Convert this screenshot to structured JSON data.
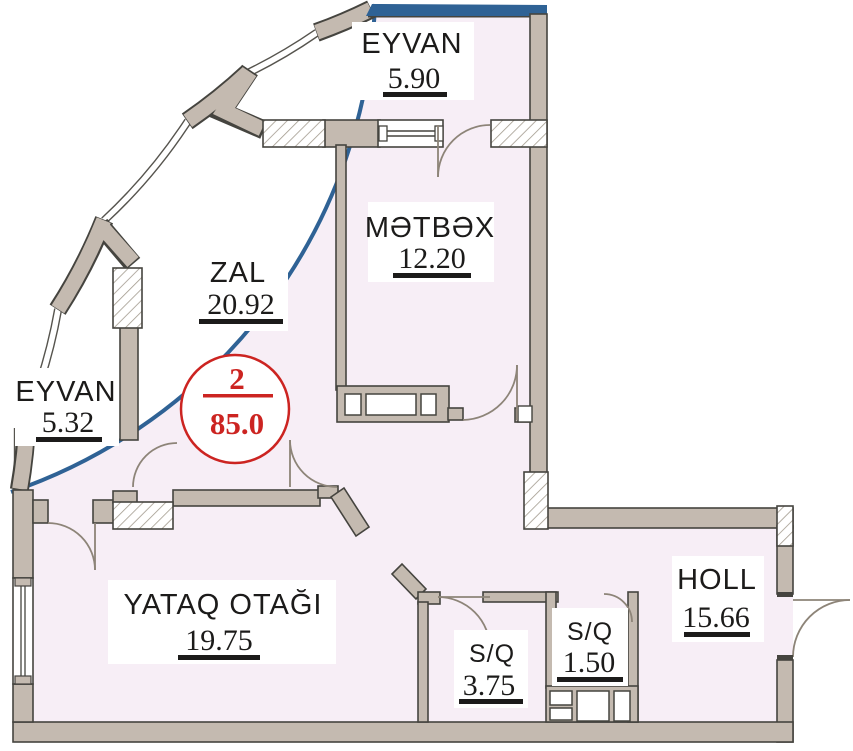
{
  "plan": {
    "title": "apartment-floor-plan",
    "badge": {
      "rooms_count": "2",
      "total_area": "85.0"
    },
    "rooms": [
      {
        "id": "eyvan-top",
        "name": "EYVAN",
        "area": "5.90"
      },
      {
        "id": "metbex",
        "name": "MƏTBƏX",
        "area": "12.20"
      },
      {
        "id": "zal",
        "name": "ZAL",
        "area": "20.92"
      },
      {
        "id": "eyvan-left",
        "name": "EYVAN",
        "area": "5.32"
      },
      {
        "id": "yataq",
        "name": "YATAQ OTAĞI",
        "area": "19.75"
      },
      {
        "id": "holl",
        "name": "HOLL",
        "area": "15.66"
      },
      {
        "id": "sq-large",
        "name": "S/Q",
        "area": "3.75"
      },
      {
        "id": "sq-small",
        "name": "S/Q",
        "area": "1.50"
      }
    ],
    "colors": {
      "interior": "#f7eef6",
      "wall": "#c4bab0",
      "outline": "#45443f",
      "accent_blue": "#2f6295",
      "badge_red": "#cc2421"
    }
  }
}
